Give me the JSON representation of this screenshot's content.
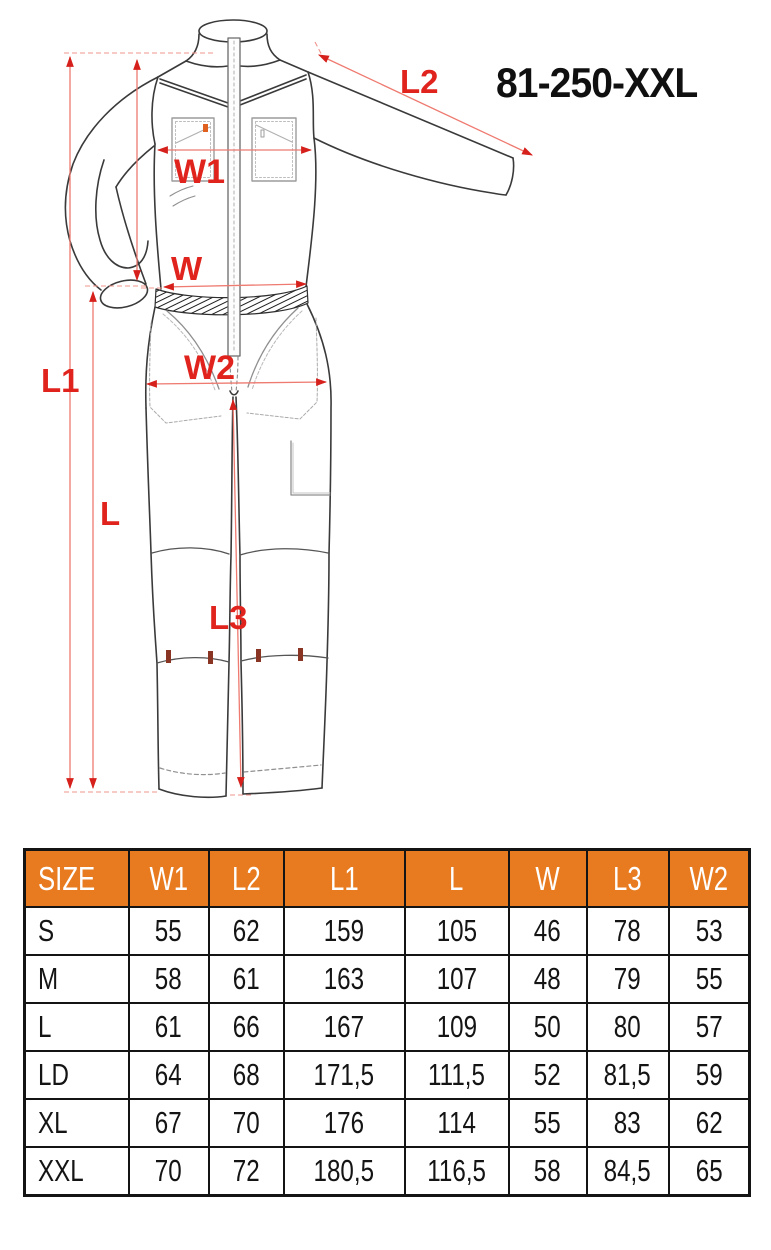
{
  "product": {
    "code": "81-250-XXL"
  },
  "colors": {
    "accent_orange": "#e87b20",
    "annotation_red": "#e0231d"
  },
  "diagram": {
    "labels": {
      "w1": "W1",
      "l2": "L2",
      "w": "W",
      "w2": "W2",
      "l1": "L1",
      "l": "L",
      "l3": "L3"
    }
  },
  "size_table": {
    "columns": [
      "SIZE",
      "W1",
      "L2",
      "L1",
      "L",
      "W",
      "L3",
      "W2"
    ],
    "rows": [
      [
        "S",
        "55",
        "62",
        "159",
        "105",
        "46",
        "78",
        "53"
      ],
      [
        "M",
        "58",
        "61",
        "163",
        "107",
        "48",
        "79",
        "55"
      ],
      [
        "L",
        "61",
        "66",
        "167",
        "109",
        "50",
        "80",
        "57"
      ],
      [
        "LD",
        "64",
        "68",
        "171,5",
        "111,5",
        "52",
        "81,5",
        "59"
      ],
      [
        "XL",
        "67",
        "70",
        "176",
        "114",
        "55",
        "83",
        "62"
      ],
      [
        "XXL",
        "70",
        "72",
        "180,5",
        "116,5",
        "58",
        "84,5",
        "65"
      ]
    ]
  }
}
